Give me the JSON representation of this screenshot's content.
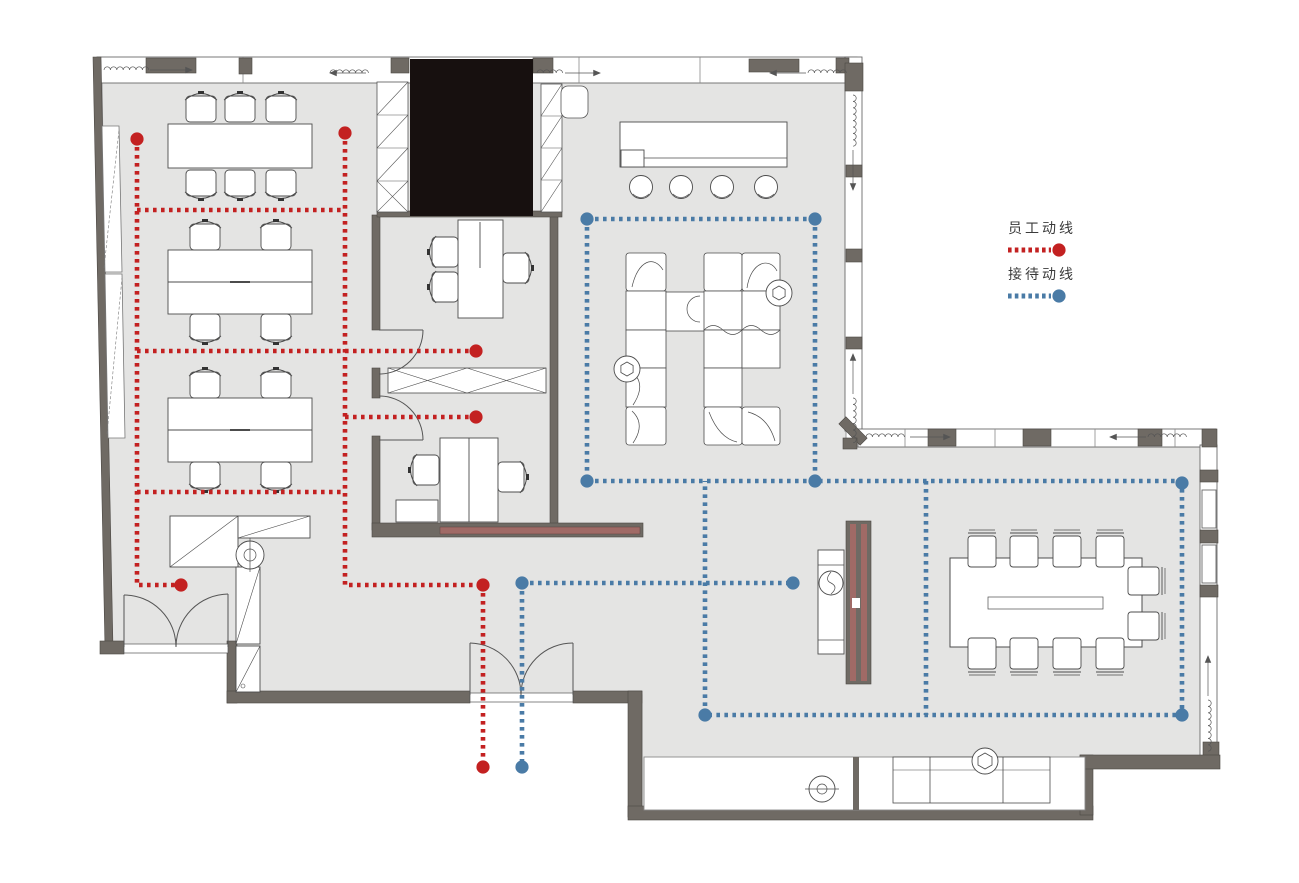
{
  "title": "office-floor-plan-circulation-diagram",
  "legend": {
    "items": [
      {
        "id": "staff",
        "label": "员工动线",
        "color": "#c32121"
      },
      {
        "id": "reception",
        "label": "接待动线",
        "color": "#4a7ba6"
      }
    ]
  },
  "circulation": {
    "dash": "3.6 4.4",
    "stroke_width": 4.6,
    "dot_radius": 6.6,
    "routes": [
      {
        "group": "staff-route",
        "color": "#c32121",
        "paths": [
          [
            [
              137,
              139
            ],
            [
              137,
              585
            ],
            [
              181,
              585
            ]
          ],
          [
            [
              345,
              133
            ],
            [
              345,
              585
            ],
            [
              483,
              585
            ]
          ],
          [
            [
              483,
              585
            ],
            [
              483,
              767
            ]
          ],
          [
            [
              137,
              210
            ],
            [
              345,
              210
            ]
          ],
          [
            [
              137,
              351
            ],
            [
              476,
              351
            ]
          ],
          [
            [
              345,
              417
            ],
            [
              476,
              417
            ]
          ],
          [
            [
              137,
              492
            ],
            [
              345,
              492
            ]
          ]
        ],
        "dots": [
          [
            137,
            139
          ],
          [
            345,
            133
          ],
          [
            476,
            351
          ],
          [
            476,
            417
          ],
          [
            181,
            585
          ],
          [
            483,
            585
          ],
          [
            483,
            767
          ]
        ]
      },
      {
        "group": "reception-route",
        "color": "#4a7ba6",
        "paths": [
          [
            [
              587,
              219
            ],
            [
              815,
              219
            ]
          ],
          [
            [
              587,
              219
            ],
            [
              587,
              481
            ]
          ],
          [
            [
              815,
              219
            ],
            [
              815,
              481
            ]
          ],
          [
            [
              587,
              481
            ],
            [
              1182,
              481
            ]
          ],
          [
            [
              1182,
              481
            ],
            [
              1182,
              715
            ],
            [
              705,
              715
            ],
            [
              705,
              481
            ]
          ],
          [
            [
              926,
              481
            ],
            [
              926,
              715
            ]
          ],
          [
            [
              522,
              583
            ],
            [
              793,
              583
            ]
          ],
          [
            [
              522,
              583
            ],
            [
              522,
              767
            ]
          ]
        ],
        "dots": [
          [
            587,
            219
          ],
          [
            815,
            219
          ],
          [
            587,
            481
          ],
          [
            815,
            481
          ],
          [
            1182,
            483
          ],
          [
            1182,
            715
          ],
          [
            705,
            715
          ],
          [
            793,
            583
          ],
          [
            522,
            583
          ],
          [
            522,
            767
          ]
        ]
      }
    ]
  }
}
